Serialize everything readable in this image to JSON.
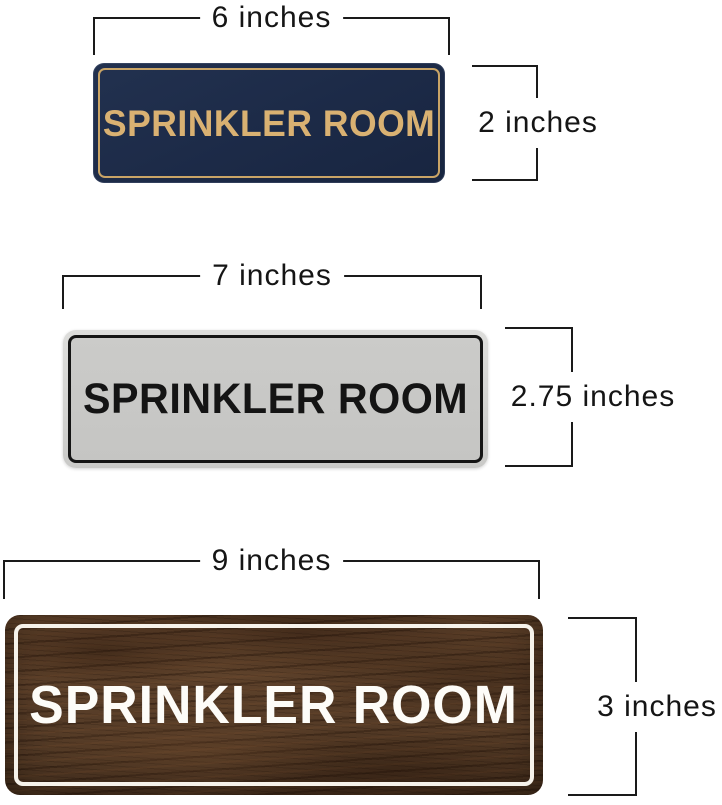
{
  "background": "#ffffff",
  "dimension_line_color": "#1a1a1a",
  "dimension_label_color": "#151515",
  "figures": [
    {
      "id": "sign-6x2",
      "width_label": "6 inches",
      "height_label": "2 inches",
      "sign_text": "SPRINKLER ROOM",
      "style": "navy-with-gold-border",
      "colors": {
        "plate": "#1c2a47",
        "inner_border": "#c9a466",
        "text": "#d9b172"
      }
    },
    {
      "id": "sign-7x2.75",
      "width_label": "7 inches",
      "height_label": "2.75 inches",
      "sign_text": "SPRINKLER ROOM",
      "style": "silver-with-black-border",
      "colors": {
        "plate": "#c7c7c5",
        "rim": "#d6d6d4",
        "inner_border": "#141414",
        "text": "#141414"
      }
    },
    {
      "id": "sign-9x3",
      "width_label": "9 inches",
      "height_label": "3 inches",
      "sign_text": "SPRINKLER ROOM",
      "style": "walnut-wood-with-white-border",
      "colors": {
        "plate": "#563c27",
        "inner_border": "#f6f2ea",
        "text": "#fdfcf8"
      }
    }
  ]
}
